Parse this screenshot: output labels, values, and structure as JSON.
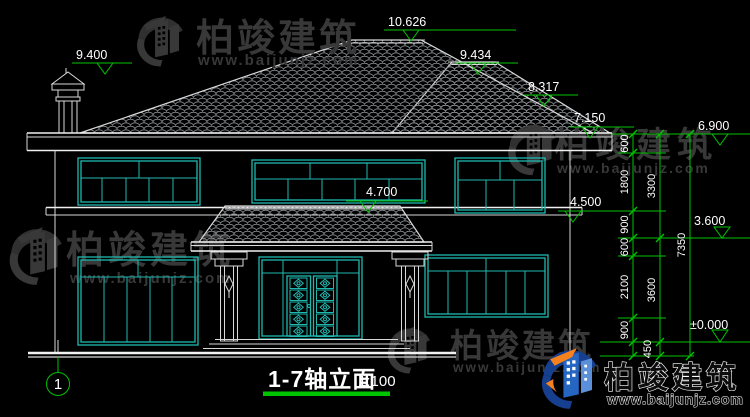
{
  "drawing": {
    "title": "1-7轴立面",
    "scale": "1:100",
    "axis_label": "1"
  },
  "elevation_marks": {
    "left_roof": "9.400",
    "main_ridge": "10.626",
    "right_ridge": "9.434",
    "right_hip": "8.317",
    "main_eave": "7.150",
    "right_eave": "6.900",
    "porch_canopy": "4.700",
    "second_floor": "4.500",
    "window_sill": "3.600",
    "ground_floor": "±0.000"
  },
  "dimensions": {
    "chain_inner": [
      "600",
      "1800",
      "900",
      "600",
      "2100",
      "900"
    ],
    "chain_middle": [
      "3300",
      "3600",
      "450"
    ],
    "chain_outer": [
      "7350"
    ]
  },
  "watermark": {
    "brand": "柏竣建筑",
    "website": "www.baijunjz.com"
  },
  "colors": {
    "background": "#000000",
    "linework": "#d9d9d9",
    "window": "#20b9b0",
    "dimension_green": "#00c400",
    "watermark_gray": "#383838",
    "logo_blue": "#2566c2",
    "logo_navy": "#163f8f",
    "logo_orange": "#f5821f"
  }
}
